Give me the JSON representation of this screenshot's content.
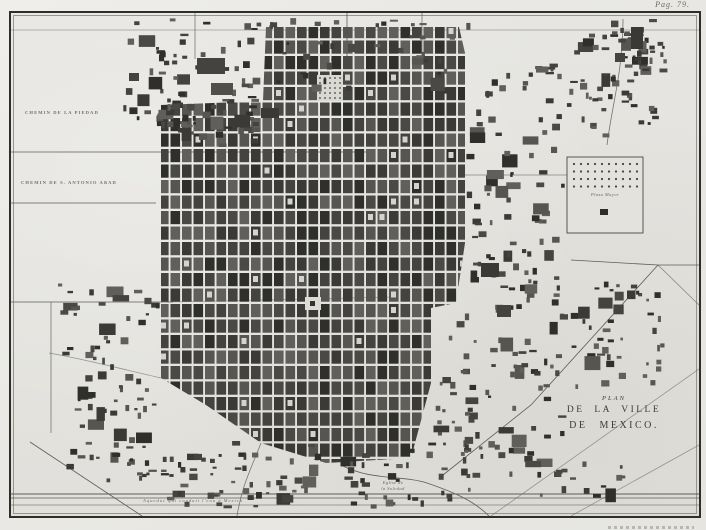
{
  "page": {
    "corner_label": "Pag. 79."
  },
  "title_block": {
    "line1": "PLAN",
    "line2": "DE LA VILLE",
    "line3": "DE MEXICO."
  },
  "map_labels": {
    "road_upper_left": "CHEMIN DE LA PIEDAD",
    "road_lower_left": "CHEMIN DE S. ANTONIO ABAD",
    "plaza_right": "Plaza Mayor",
    "church_bottom_line1": "Eglise de",
    "church_bottom_line2": "la Soledad",
    "aqueduct_bottom": "Aqueduc qui conduit l'eau à Mexico"
  },
  "colors": {
    "paper": "#e4e3df",
    "margin": "#eceae6",
    "ink": "#3a3934",
    "city_block": "#4a4945",
    "city_block_dark": "#2f2f2c",
    "street": "#d8d7d2",
    "frame": "#2f2e2b"
  }
}
